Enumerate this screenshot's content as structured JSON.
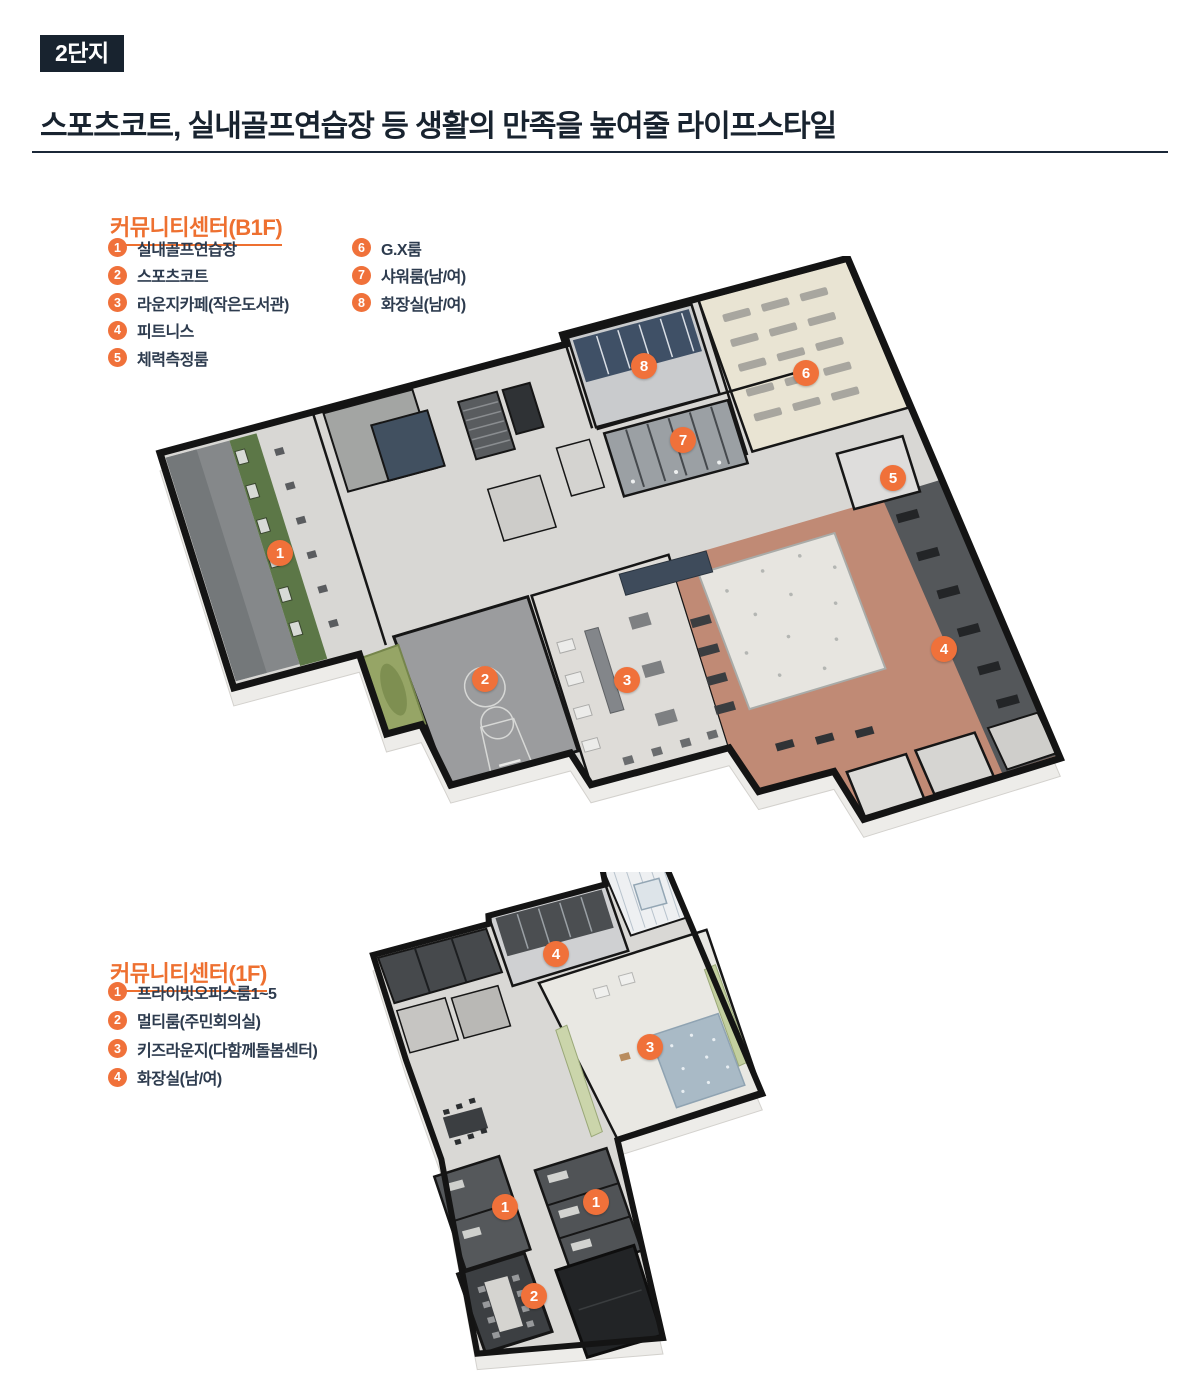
{
  "page": {
    "badge": "2단지",
    "title": "스포츠코트, 실내골프연습장 등 생활의 만족을 높여줄 라이프스타일"
  },
  "colors": {
    "accent": "#ee7030",
    "navy": "#1b2838",
    "marker_orange": "#f0713a"
  },
  "sections": {
    "b1f": {
      "heading": "커뮤니티센터(B1F)",
      "legend_columns": [
        [
          {
            "n": "1",
            "label": "실내골프연습장"
          },
          {
            "n": "2",
            "label": "스포츠코트"
          },
          {
            "n": "3",
            "label": "라운지카페(작은도서관)"
          },
          {
            "n": "4",
            "label": "피트니스"
          },
          {
            "n": "5",
            "label": "체력측정룸"
          }
        ],
        [
          {
            "n": "6",
            "label": "G.X룸"
          },
          {
            "n": "7",
            "label": "샤워룸(남/여)"
          },
          {
            "n": "8",
            "label": "화장실(남/여)"
          }
        ]
      ],
      "markers": [
        {
          "n": "1",
          "x": 280,
          "y": 553
        },
        {
          "n": "2",
          "x": 485,
          "y": 679
        },
        {
          "n": "3",
          "x": 627,
          "y": 680
        },
        {
          "n": "4",
          "x": 944,
          "y": 649
        },
        {
          "n": "5",
          "x": 893,
          "y": 478
        },
        {
          "n": "6",
          "x": 806,
          "y": 373
        },
        {
          "n": "7",
          "x": 683,
          "y": 440
        },
        {
          "n": "8",
          "x": 644,
          "y": 366
        }
      ]
    },
    "f1": {
      "heading": "커뮤니티센터(1F)",
      "legend_columns": [
        [
          {
            "n": "1",
            "label": "프라이빗오피스룸1~5"
          },
          {
            "n": "2",
            "label": "멀티룸(주민회의실)"
          },
          {
            "n": "3",
            "label": "키즈라운지(다함께돌봄센터)"
          },
          {
            "n": "4",
            "label": "화장실(남/여)"
          }
        ]
      ],
      "markers": [
        {
          "n": "4",
          "x": 556,
          "y": 954
        },
        {
          "n": "3",
          "x": 650,
          "y": 1047
        },
        {
          "n": "1",
          "x": 505,
          "y": 1207
        },
        {
          "n": "1",
          "x": 596,
          "y": 1202
        },
        {
          "n": "2",
          "x": 534,
          "y": 1296
        }
      ]
    }
  }
}
